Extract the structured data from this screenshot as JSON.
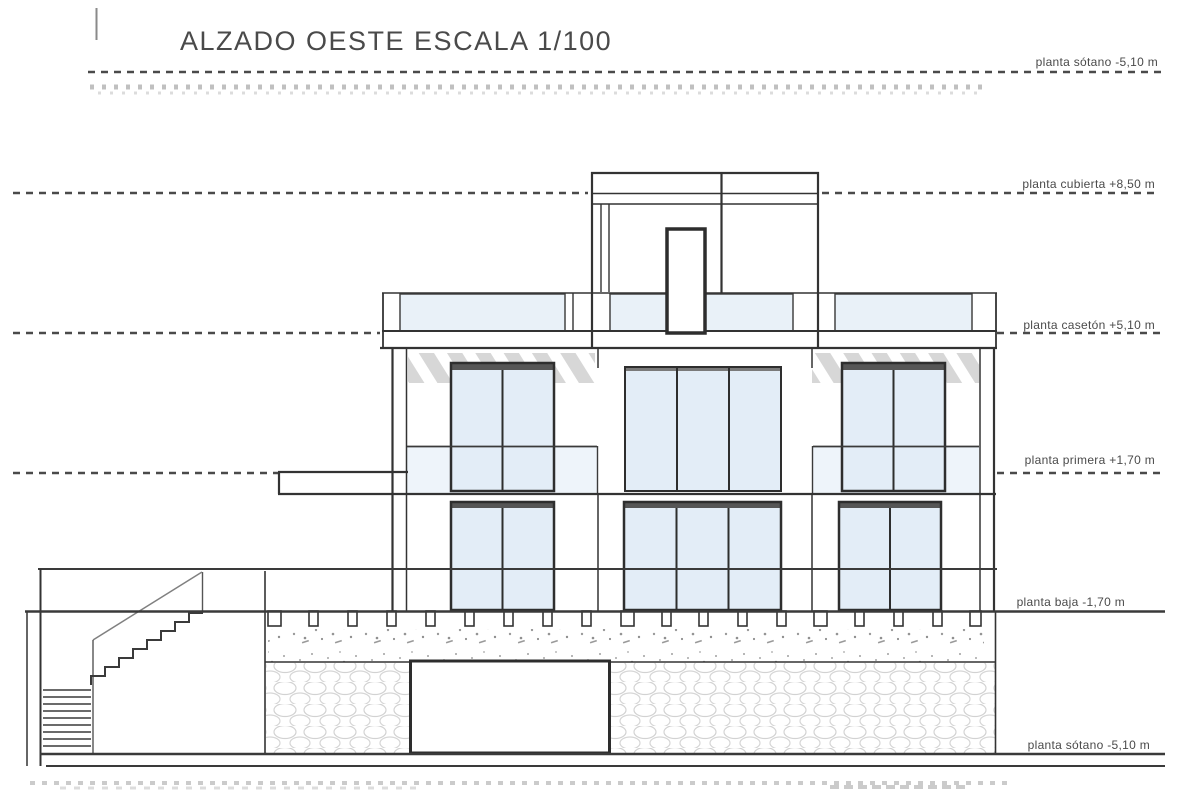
{
  "title": "ALZADO OESTE ESCALA 1/100",
  "drawing": {
    "type": "architectural-elevation",
    "scale": "1/100",
    "orientation": "oeste",
    "levels": [
      {
        "id": "sotano-upper",
        "label": "planta sótano -5,10 m",
        "elevation_m": -5.1,
        "line_style": "dashed"
      },
      {
        "id": "cubierta",
        "label": "planta cubierta +8,50 m",
        "elevation_m": 8.5,
        "line_style": "dashed"
      },
      {
        "id": "caseton",
        "label": "planta casetón +5,10 m",
        "elevation_m": 5.1,
        "line_style": "dashed"
      },
      {
        "id": "primera",
        "label": "planta primera +1,70 m",
        "elevation_m": 1.7,
        "line_style": "dashed"
      },
      {
        "id": "baja",
        "label": "planta baja -1,70 m",
        "elevation_m": -1.7,
        "line_style": "solid"
      },
      {
        "id": "sotano",
        "label": "planta sótano -5,10 m",
        "elevation_m": -5.1,
        "line_style": "solid"
      }
    ],
    "colors": {
      "line": "#333333",
      "label": "#4a4a4a",
      "glass": "#e3edf7",
      "glass_light": "#eef4fa",
      "rail_dark": "#565656",
      "hatch": "#d7d7d7",
      "pebble_outline": "#d2d2d2",
      "stipple": "#9a9a9a"
    }
  }
}
